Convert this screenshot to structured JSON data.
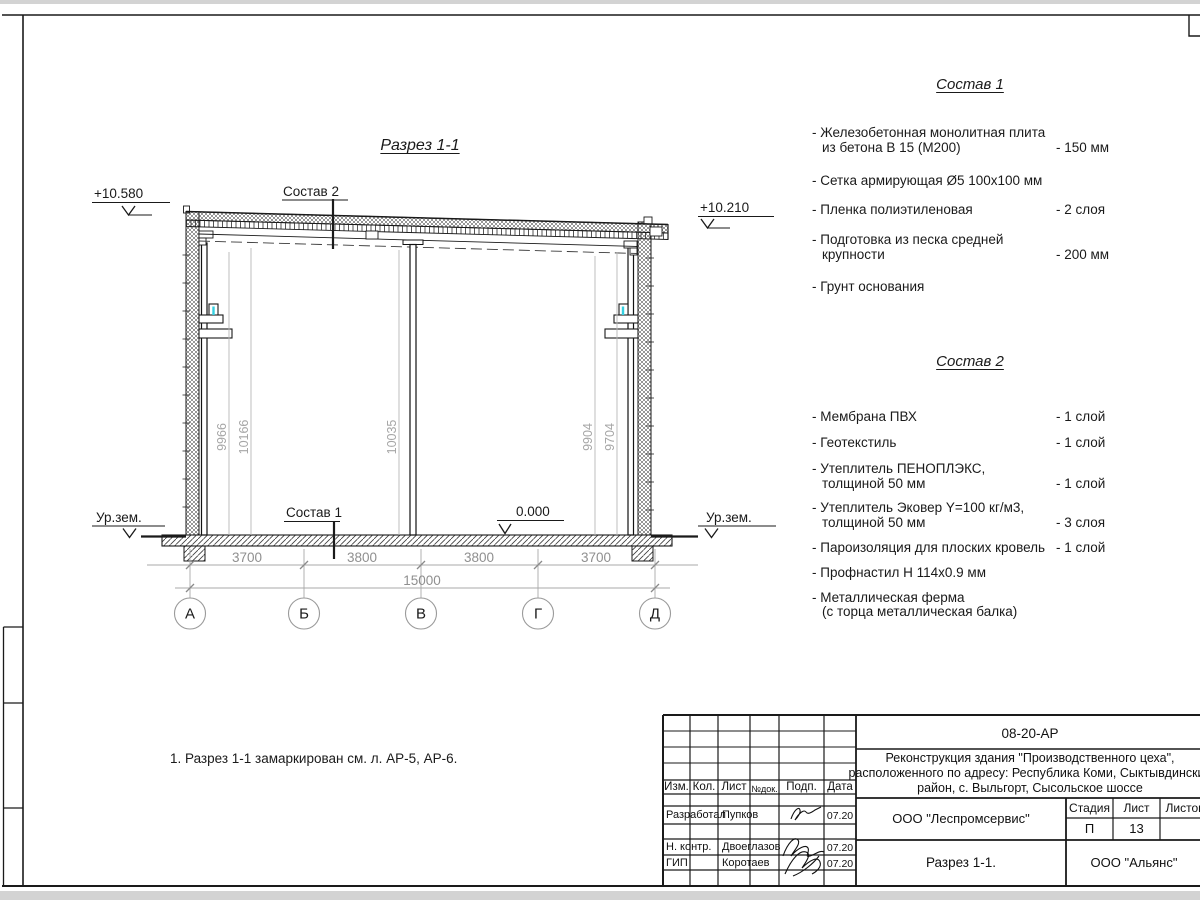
{
  "colors": {
    "accent_cyan": "#35cfe0",
    "dim_gray": "#9a9a9a"
  },
  "drawing": {
    "title": "Разрез 1-1",
    "sostav2_label": "Состав 2",
    "sostav1_label": "Состав 1",
    "elev_left": "+10.580",
    "elev_right": "+10.210",
    "elev_zero": "0.000",
    "ground_left": "Ур.зем.",
    "ground_right": "Ур.зем.",
    "vdims": [
      "9966",
      "10166",
      "10035",
      "9904",
      "9704"
    ],
    "hdims": [
      "3700",
      "3800",
      "3800",
      "3700"
    ],
    "total_dim": "15000",
    "axes": [
      "А",
      "Б",
      "В",
      "Г",
      "Д"
    ],
    "note": "1. Разрез 1-1 замаркирован см. л. АР-5, АР-6."
  },
  "sostav1": {
    "title": "Состав 1",
    "items": [
      {
        "l1": "- Железобетонная  монолитная плита",
        "l2": "из бетона В 15 (М200)",
        "qty": "- 150 мм"
      },
      {
        "l1": "- Сетка армирующая Ø5 100x100 мм",
        "l2": "",
        "qty": ""
      },
      {
        "l1": "- Пленка полиэтиленовая",
        "l2": "",
        "qty": "-  2 слоя"
      },
      {
        "l1": "- Подготовка из песка средней",
        "l2": "крупности",
        "qty": "- 200 мм"
      },
      {
        "l1": "- Грунт основания",
        "l2": "",
        "qty": ""
      }
    ]
  },
  "sostav2": {
    "title": "Состав 2",
    "items": [
      {
        "l1": "- Мембрана ПВХ",
        "l2": "",
        "qty": "- 1 слой"
      },
      {
        "l1": "- Геотекстиль",
        "l2": "",
        "qty": "- 1 слой"
      },
      {
        "l1": "- Утеплитель ПЕНОПЛЭКС,",
        "l2": "толщиной 50 мм",
        "qty": "- 1 слой"
      },
      {
        "l1": "- Утеплитель Эковер Y=100 кг/м3,",
        "l2": "толщиной 50 мм",
        "qty": "- 3 слоя"
      },
      {
        "l1": "- Пароизоляция для плоских кровель",
        "l2": "",
        "qty": "- 1 слой"
      },
      {
        "l1": "- Профнастил Н 114х0.9 мм",
        "l2": "",
        "qty": ""
      },
      {
        "l1": "- Металлическая ферма",
        "l2": "(с торца металлическая балка)",
        "qty": ""
      }
    ]
  },
  "titleblock": {
    "code": "08-20-АР",
    "project_l1": "Реконструкция здания \"Производственного цеха\",",
    "project_l2": "расположенного по адресу: Республика Коми, Сыктывдинский",
    "project_l3": "район, с. Выльгорт, Сысольское шоссе",
    "col_izm": "Изм.",
    "col_kol": "Кол.",
    "col_list": "Лист",
    "col_ndok": "№док.",
    "col_podp": "Подп.",
    "col_data": "Дата",
    "rows": [
      {
        "role": "Разработал",
        "name": "Пупков",
        "date": "07.20"
      },
      {
        "role": "Н. контр.",
        "name": "Двоеглазов",
        "date": "07.20"
      },
      {
        "role": "ГИП",
        "name": "Коротаев",
        "date": "07.20"
      }
    ],
    "org": "ООО \"Леспромсервис\"",
    "stage_label": "Стадия",
    "sheet_label": "Лист",
    "sheets_label": "Листов",
    "stage": "П",
    "sheet": "13",
    "sheets": "",
    "doc_title": "Разрез 1-1.",
    "org2": "ООО \"Альянс\""
  }
}
